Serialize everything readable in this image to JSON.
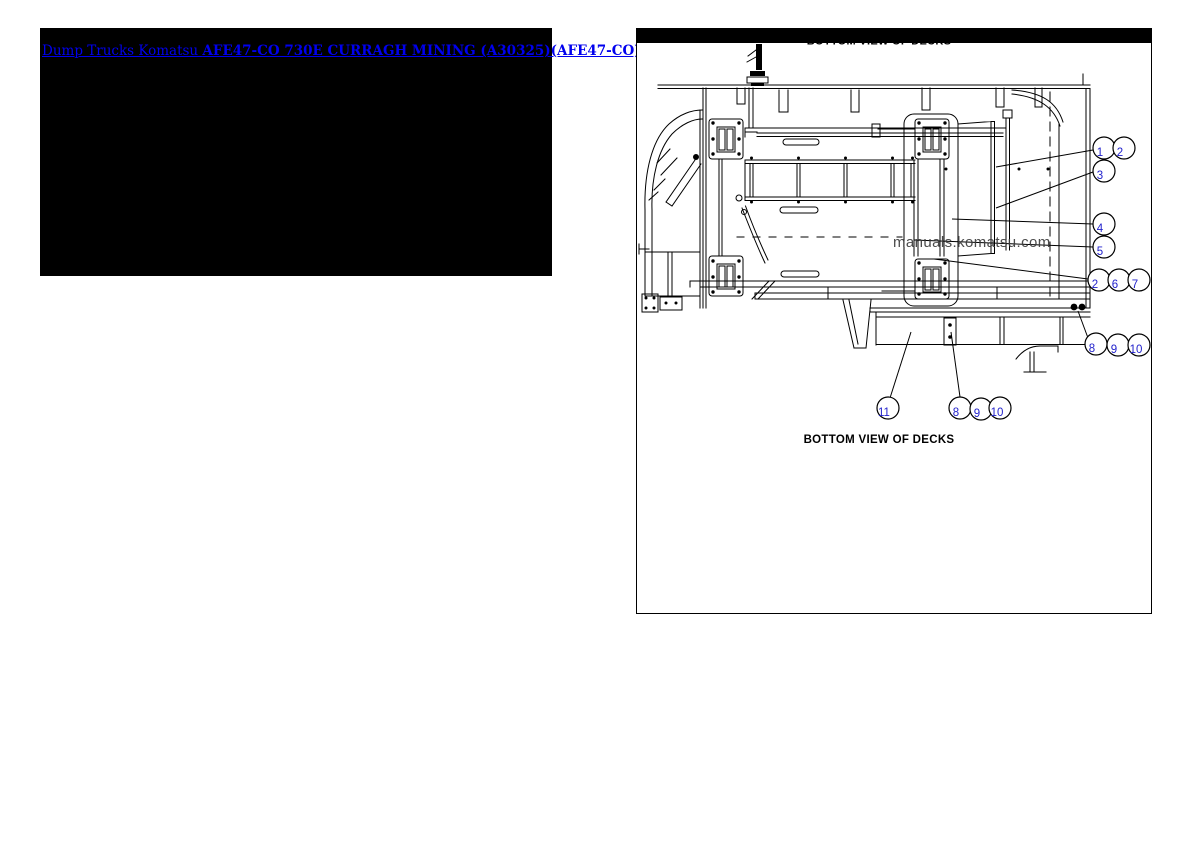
{
  "header_link": {
    "prefix": "Dump Trucks Komatsu ",
    "model": "AFE47-CO 730E CURRAGH MINING (A30325)(AFE47-CO)"
  },
  "panel": {
    "top_title": "BOTTOM VIEW OF DECKS",
    "caption": "BOTTOM VIEW OF DECKS",
    "watermark": "manuals.komatsu.com"
  },
  "callouts": [
    "1",
    "2",
    "3",
    "4",
    "5",
    "2",
    "6",
    "7",
    "8",
    "9",
    "10",
    "11",
    "8",
    "9",
    "10"
  ],
  "colors": {
    "link_blue": "#0000ee",
    "callout_blue": "#2222cc",
    "line": "#000000",
    "watermark_gray": "#3c3c3c",
    "header_background": "#000000"
  }
}
